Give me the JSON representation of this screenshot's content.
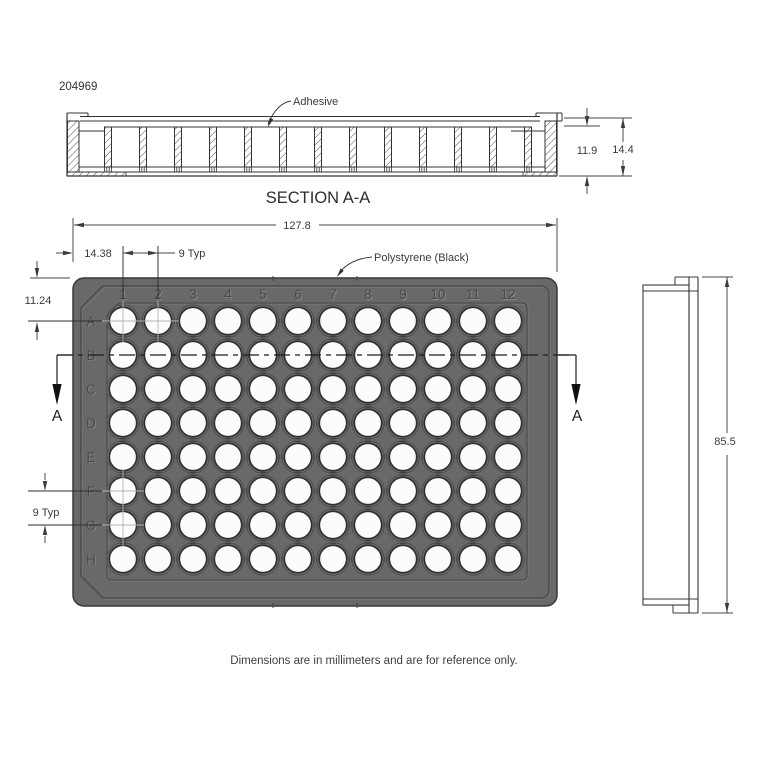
{
  "title_block": {
    "part_number": "204969"
  },
  "section_view": {
    "title": "SECTION A-A",
    "adhesive_label": "Adhesive",
    "dim_cavity_height": "11.9",
    "dim_total_height": "14.4"
  },
  "plan_view": {
    "material_label": "Polystyrene (Black)",
    "dim_overall_width": "127.8",
    "dim_first_column_offset": "14.38",
    "dim_column_pitch": "9 Typ",
    "dim_first_row_offset": "11.24",
    "dim_row_pitch": "9 Typ",
    "section_cut_label": "A",
    "column_labels": [
      "1",
      "2",
      "3",
      "4",
      "5",
      "6",
      "7",
      "8",
      "9",
      "10",
      "11",
      "12"
    ],
    "row_labels": [
      "A",
      "B",
      "C",
      "D",
      "E",
      "F",
      "G",
      "H"
    ],
    "marked_wells": [
      "A1",
      "A2",
      "F1",
      "G1"
    ],
    "body_color": "#696969"
  },
  "side_view": {
    "dim_overall_length": "85.5"
  },
  "footnote": "Dimensions are in millimeters and are for reference only."
}
